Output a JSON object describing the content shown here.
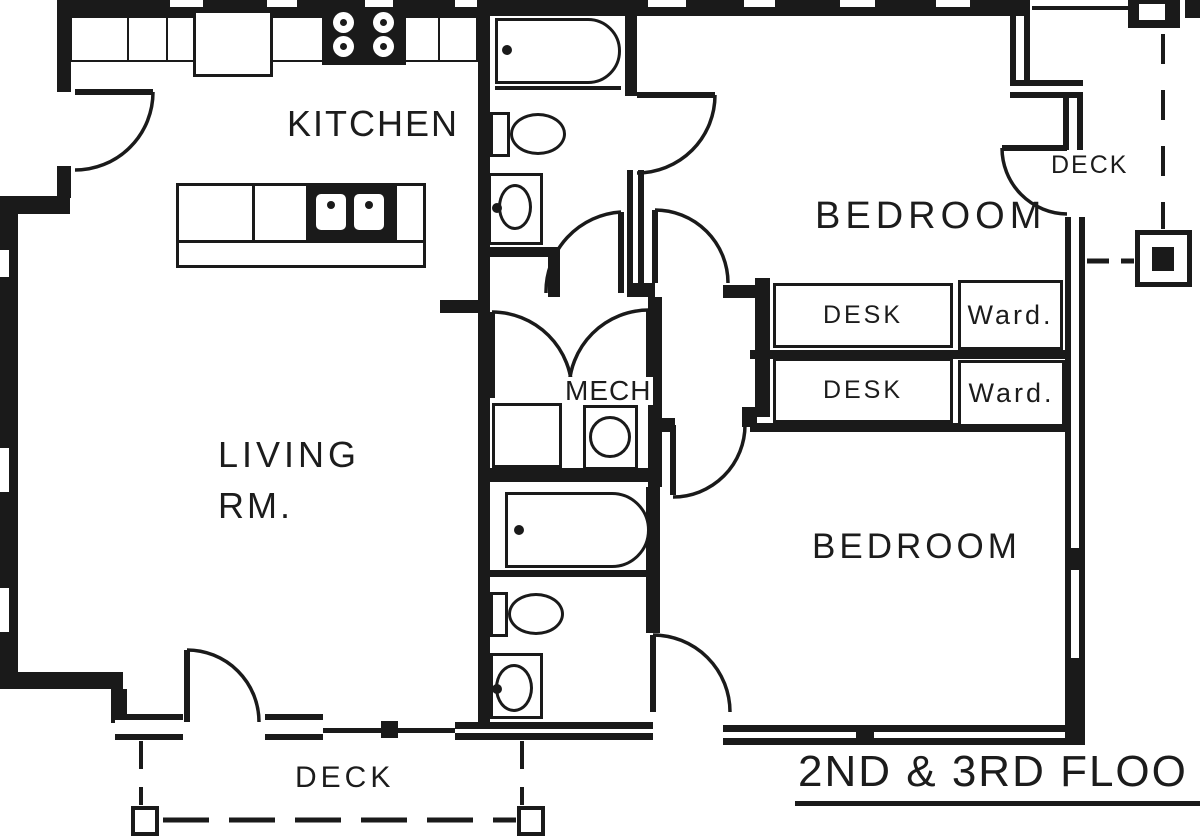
{
  "colors": {
    "ink": "#1a1a1a",
    "paper": "#ffffff"
  },
  "rooms": {
    "kitchen": "KITCHEN",
    "living_line1": "LIVING",
    "living_line2": "RM.",
    "bedroom_top": "BEDROOM",
    "bedroom_bottom": "BEDROOM",
    "mech": "MECH"
  },
  "furniture": {
    "desk_top": "DESK",
    "desk_bottom": "DESK",
    "wardrobe_top": "Ward.",
    "wardrobe_bottom": "Ward."
  },
  "outdoor": {
    "deck_upper": "DECK",
    "deck_lower": "DECK"
  },
  "caption": "2ND & 3RD FLOO"
}
